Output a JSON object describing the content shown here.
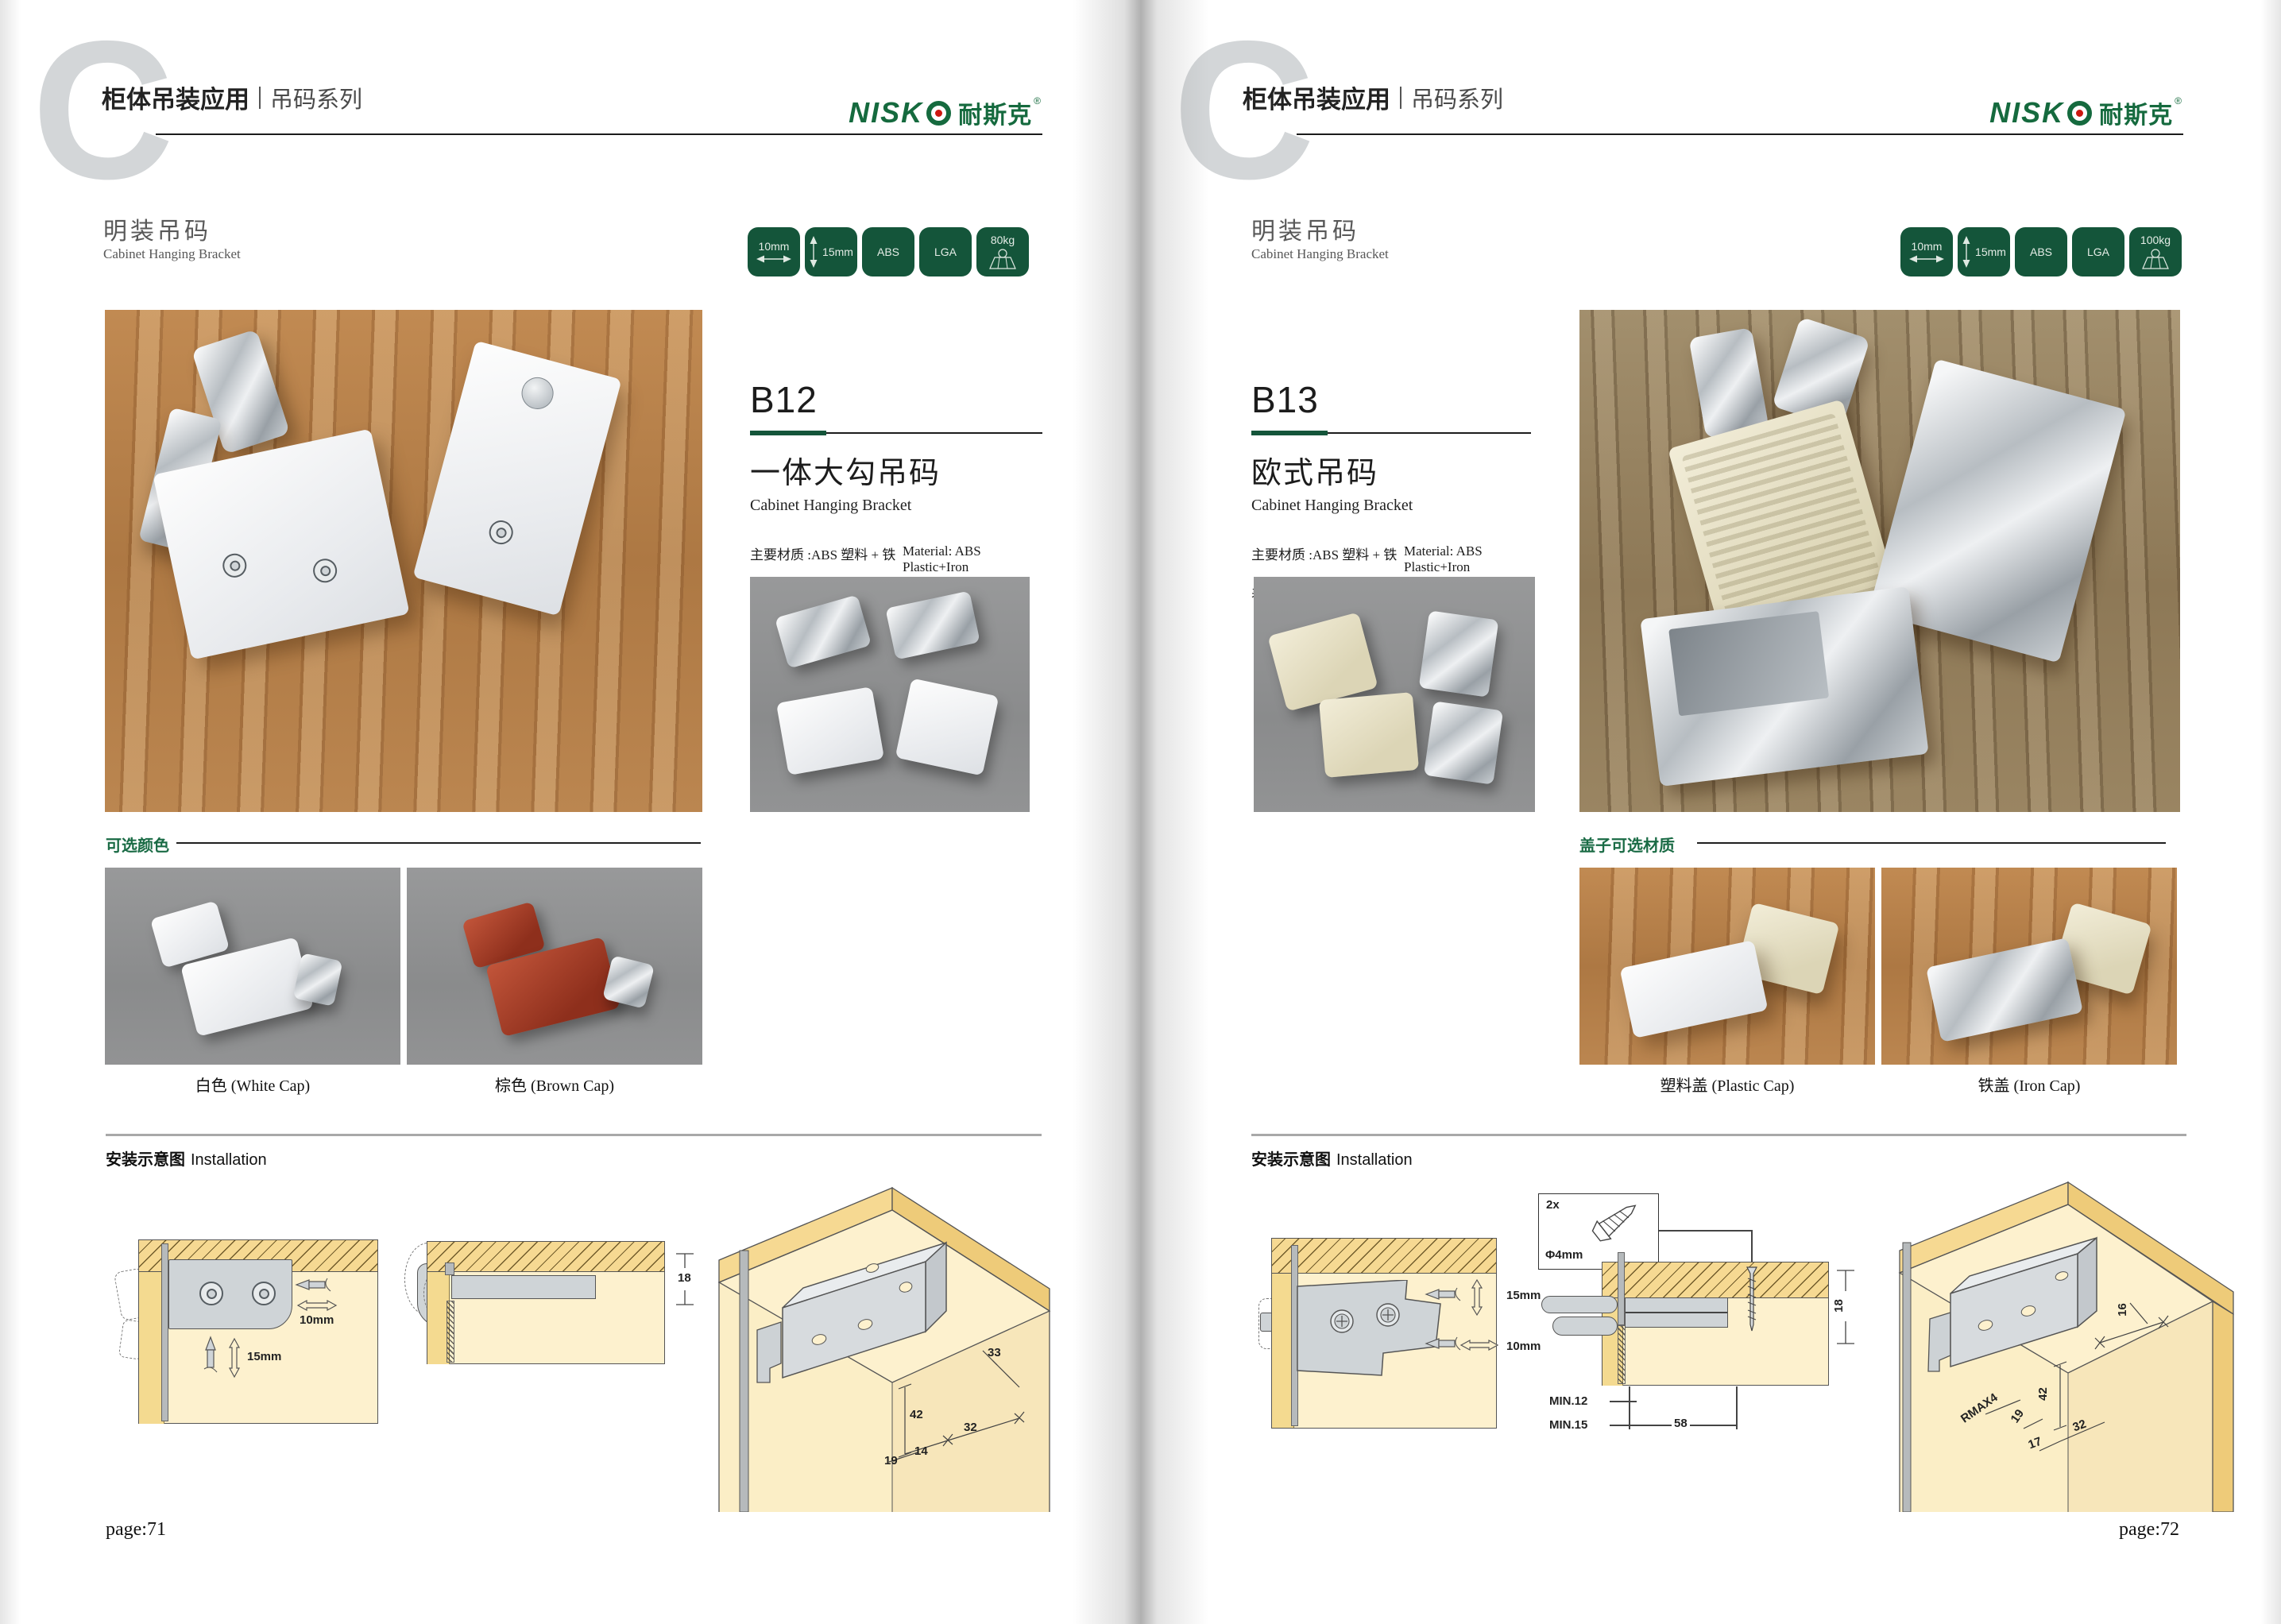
{
  "header": {
    "letter": "C",
    "title_bold": "柜体吊装应用",
    "title_light": "吊码系列"
  },
  "brand": {
    "latin": "NISK",
    "cjk": "耐斯克",
    "reg": "®"
  },
  "section": {
    "cn": "明装吊码",
    "en": "Cabinet Hanging Bracket"
  },
  "colors": {
    "badge_green": "#14553a",
    "accent_green": "#1a6b45",
    "logo_green": "#156a3e",
    "logo_red": "#cc1810"
  },
  "pages": [
    {
      "badges": [
        {
          "label": "10mm"
        },
        {
          "label": "15mm"
        },
        {
          "label": "ABS"
        },
        {
          "label": "LGA"
        },
        {
          "label": "80kg"
        }
      ],
      "product": {
        "code": "B12",
        "name_cn": "一体大勾吊码",
        "name_en": "Cabinet Hanging Bracket",
        "material_cn": "主要材质 :ABS 塑料 + 铁",
        "material_en": "Material: ABS Plastic+Iron",
        "finish_cn": "表面处理 : 白色、棕色",
        "finish_en": "Finish:White,Brown"
      },
      "options": {
        "label": "可选颜色",
        "captions": [
          "白色 (White Cap)",
          "棕色 (Brown Cap)"
        ]
      },
      "install": {
        "label_cn": "安装示意图",
        "label_en": "Installation",
        "dims": {
          "width": "10mm",
          "height": "15mm",
          "depth": "18",
          "a": "33",
          "b": "42",
          "c": "32",
          "d": "14",
          "e": "19"
        }
      },
      "page_label": "page:71"
    },
    {
      "badges": [
        {
          "label": "10mm"
        },
        {
          "label": "15mm"
        },
        {
          "label": "ABS"
        },
        {
          "label": "LGA"
        },
        {
          "label": "100kg"
        }
      ],
      "product": {
        "code": "B13",
        "name_cn": "欧式吊码",
        "name_en": "Cabinet Hanging Bracket",
        "material_cn": "主要材质 :ABS 塑料 + 铁",
        "material_en": "Material: ABS Plastic+Iron",
        "finish_cn": "表面处理 : 镀镍",
        "finish_en": "Finish:Nickel plating"
      },
      "options": {
        "label": "盖子可选材质",
        "captions": [
          "塑料盖 (Plastic Cap)",
          "铁盖 (Iron Cap)"
        ]
      },
      "install": {
        "label_cn": "安装示意图",
        "label_en": "Installation",
        "screw_qty": "2x",
        "screw_dia": "Φ4mm",
        "dims": {
          "height": "15mm",
          "width": "10mm",
          "depth": "18",
          "min1": "MIN.12",
          "min2": "MIN.15",
          "len": "58",
          "a": "16",
          "b": "42",
          "r": "RMAX4",
          "c": "19",
          "d": "17",
          "e": "32"
        }
      },
      "page_label": "page:72"
    }
  ]
}
